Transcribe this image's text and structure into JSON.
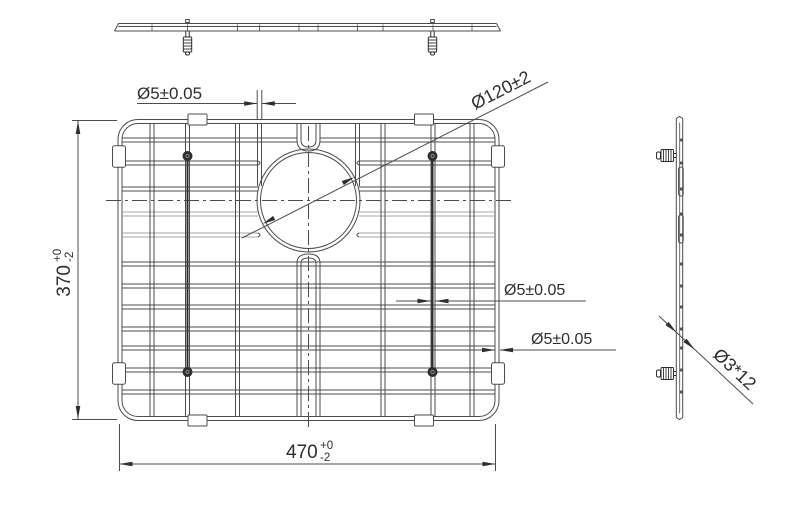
{
  "drawing_title": "Wire sink grid engineering drawing - three views",
  "background": "#ffffff",
  "colors": {
    "line": "#4c4c4c",
    "dark": "#2e2e2e",
    "light_wire": "#a6a6a6",
    "text": "#2e2e2e",
    "fill_white": "#ffffff"
  },
  "annotations": {
    "wire_dia_top": "Ø5±0.05",
    "hole_dia": "Ø120±2",
    "wire_dia_mid": "Ø5±0.05",
    "wire_dia_frame": "Ø5±0.05",
    "height_value": "370",
    "height_tol_upper": "+0",
    "height_tol_lower": "-2",
    "width_value": "470",
    "width_tol_upper": "+0",
    "width_tol_lower": "-2",
    "foot_spec": "Ø3*12"
  },
  "geometry": {
    "front": {
      "x": 118,
      "y": 119.5,
      "w": 381,
      "h": 301,
      "corner_r": 20,
      "h_wires": [
        {
          "y": 140,
          "stub_gap": true
        },
        {
          "y": 163,
          "gap": true
        },
        {
          "y": 189,
          "gap": true
        },
        {
          "y": 214,
          "gap": true,
          "gray": true
        },
        {
          "y": 235,
          "gap": true,
          "gray": true
        },
        {
          "y": 264
        },
        {
          "y": 286
        },
        {
          "y": 307
        },
        {
          "y": 329
        },
        {
          "y": 348
        },
        {
          "y": 370
        },
        {
          "y": 392
        }
      ],
      "v_wires": [
        152,
        187.5,
        237.5,
        383,
        433,
        472
      ],
      "center_wires": [
        299,
        318
      ],
      "stub_wires": [
        259.5,
        357.5
      ],
      "stub_wire_end": 186,
      "circle": {
        "cx": 308.5,
        "cy": 200.5,
        "r": 51.5,
        "r2": 48
      },
      "gap_left": 258,
      "gap_right": 359,
      "screw_xs": [
        187.5,
        432.5
      ],
      "screw_ys": [
        156,
        372
      ],
      "tab_xs": [
        197.5,
        424
      ],
      "clip_ys": [
        156.5,
        373.5
      ]
    },
    "top": {
      "x1": 118.5,
      "x2": 496.5,
      "y_top": 23.5,
      "y_mid": 26.5,
      "y_bot": 31,
      "tick_xs": [
        152,
        187.5,
        237.5,
        259.5,
        299,
        318,
        357.5,
        383,
        433,
        472
      ],
      "feet_xs": [
        187.5,
        432.5
      ]
    },
    "side": {
      "x1": 676.3,
      "x2": 679.7,
      "x3": 682.7,
      "y1": 118.5,
      "y2": 417.5,
      "tick_ys": [
        140,
        163,
        189,
        214,
        235,
        264,
        286,
        307,
        329,
        348,
        370,
        392
      ],
      "slots": [
        {
          "y": 167,
          "h": 29
        },
        {
          "y": 215,
          "h": 28
        }
      ],
      "feet_ys": [
        155.5,
        373.5
      ]
    },
    "dims": {
      "top5": {
        "text_x": 137,
        "line_y": 103.5,
        "wire_l": 257.2,
        "wire_r": 261.8,
        "left_start": 137,
        "right_end": 296,
        "ext_top": 90
      },
      "hole": {
        "x1": 242,
        "y1": 238,
        "x2": 548,
        "y2": 82
      },
      "mid5": {
        "y": 301,
        "wire_l": 430.5,
        "wire_r": 435.5,
        "left_start": 396,
        "right_end": 586
      },
      "frame5": {
        "y": 350,
        "wire_l": 495,
        "wire_r": 500,
        "left_start": 464,
        "right_end": 616
      },
      "height": {
        "line_x": 78,
        "y_top": 121,
        "y_bot": 419,
        "ext_x1": 72,
        "ext_x2": 117
      },
      "width": {
        "line_y": 464,
        "x_left": 119.5,
        "x_right": 495.5,
        "ext_y1": 424,
        "ext_y2": 471
      },
      "foot": {
        "x1": 659,
        "y1": 316,
        "x2": 753,
        "y2": 404,
        "bar_l": 676.5,
        "bar_r": 683.5
      }
    }
  }
}
